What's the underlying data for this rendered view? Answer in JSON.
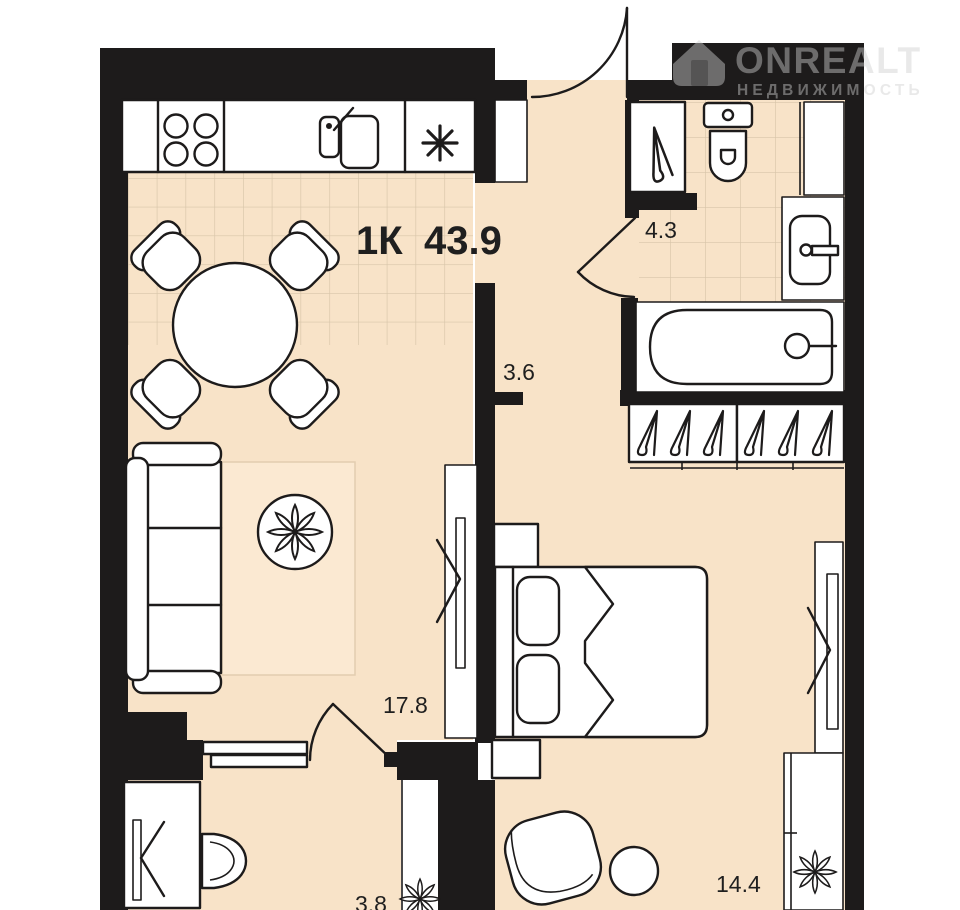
{
  "title": {
    "layout_label": "1К",
    "total_area_m2": "43.9"
  },
  "logo": {
    "brand": "ONREALT",
    "tagline": "НЕДВИЖИМОСТЬ"
  },
  "rooms": {
    "hallway": {
      "name": "hallway",
      "area_m2": "3.6"
    },
    "bathroom": {
      "name": "bathroom",
      "area_m2": "4.3"
    },
    "living_room": {
      "name": "kitchen-living",
      "area_m2": "17.8"
    },
    "bedroom": {
      "name": "bedroom",
      "area_m2": "14.4"
    },
    "utility": {
      "name": "utility",
      "area_m2": "3.8"
    }
  },
  "icons": {
    "stove": "stove-burners-icon",
    "sink": "kitchen-sink-icon",
    "fridge": "snowflake-fridge-icon",
    "plant": "plant-flower-icon",
    "hanger": "clothes-hanger-icon"
  },
  "colors": {
    "floor": "#f8e3c8",
    "wall": "#1d1b1b",
    "tile_line": "#d8c5a9",
    "outline": "#1d1b1b",
    "watermark": "#cfcfcf"
  }
}
